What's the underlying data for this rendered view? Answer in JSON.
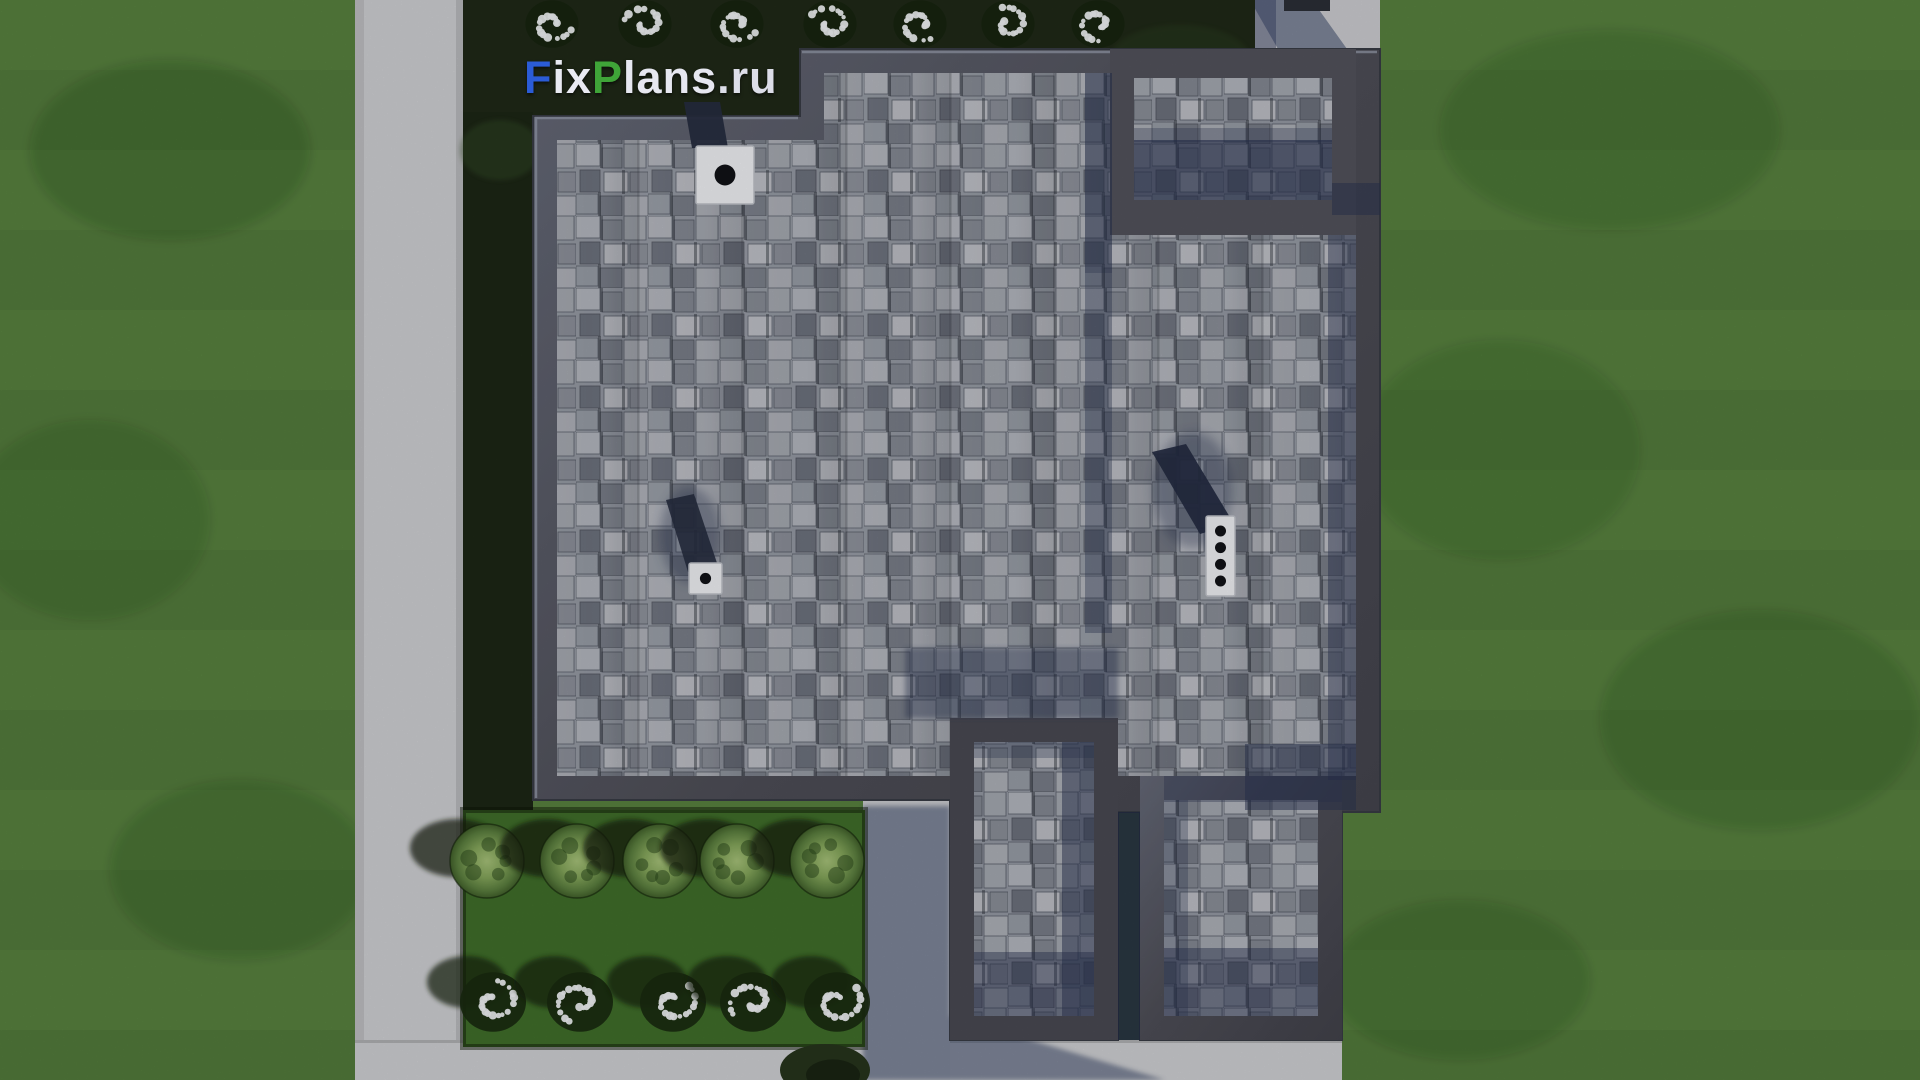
{
  "watermark": {
    "text": "FixPlans.ru",
    "parts": [
      {
        "t": "F",
        "c": "#2b5cd6"
      },
      {
        "t": "ix",
        "c": "#e9eaf2"
      },
      {
        "t": "P",
        "c": "#3fa438"
      },
      {
        "t": "lans",
        "c": "#e6e7f0"
      },
      {
        "t": ".ru",
        "c": "#dcdde8"
      }
    ]
  },
  "scene": {
    "description": "Aerial top-down 3D render of a flat-roofed house with gray stone-shingle roofing, dark parapet walls, roof vents and chimneys, surrounded by lawns, concrete walkways, a dark hedge strip and a planted garden bed",
    "palette": {
      "grass": "#598440",
      "grass_shade": "#4a7233",
      "hedge_strip": "#1f2a17",
      "garden_bed": "#41702b",
      "concrete": "#d2d3d6",
      "shadow_blue": "#2a3452",
      "parapet": "#4f4f58",
      "parapet_light": "#8d92a2",
      "tile_base": "#979ca6",
      "tile_light": "#b9bcc4",
      "tile_dark": "#6f7480",
      "cap_white": "#f4f5f8",
      "bush_green": "#86a85c",
      "flower_white": "#f3f5f8"
    },
    "roof_vents": [
      {
        "name": "chimney-cap",
        "x": 696,
        "y": 146,
        "w": 58,
        "h": 58,
        "holes": 1
      },
      {
        "name": "vent-cap",
        "x": 689,
        "y": 563,
        "w": 33,
        "h": 31,
        "holes": 1
      },
      {
        "name": "multi-flue-chimney-cap",
        "x": 1206,
        "y": 516,
        "w": 29,
        "h": 80,
        "holes": 4
      }
    ],
    "plants": {
      "flower_clusters_top": {
        "count": 7,
        "xs": [
          552,
          645,
          737,
          830,
          920,
          1008,
          1098
        ],
        "cy": 24,
        "r": 28
      },
      "bushes": {
        "count": 5,
        "xs": [
          487,
          577,
          660,
          737,
          827
        ],
        "cy": 861,
        "r": 37
      },
      "flower_clusters_bottom": {
        "count": 5,
        "xs": [
          493,
          580,
          673,
          753,
          837
        ],
        "cy": 1002,
        "r": 33
      },
      "dark_bush": {
        "x": 825,
        "cy": 1070,
        "rx": 45,
        "ry": 26
      }
    }
  }
}
